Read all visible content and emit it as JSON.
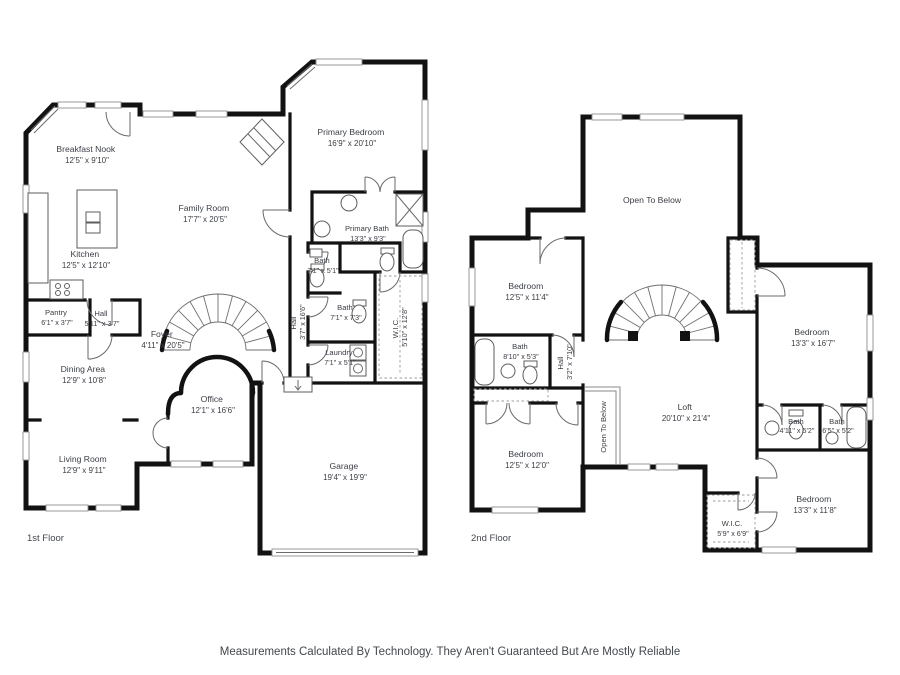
{
  "meta": {
    "disclaimer": "Measurements Calculated By Technology. They Aren't Guaranteed But Are Mostly Reliable",
    "wall_color": "#121212",
    "text_color": "#3a3e45"
  },
  "f1": {
    "floor_label": "1st Floor",
    "breakfast_nook": {
      "name": "Breakfast Nook",
      "dims": "12'5\" x 9'10\""
    },
    "kitchen": {
      "name": "Kitchen",
      "dims": "12'5\" x 12'10\""
    },
    "pantry": {
      "name": "Pantry",
      "dims": "6'1\" x 3'7\""
    },
    "hall": {
      "name": "Hall",
      "dims": "5'11\" x 3'7\""
    },
    "family_room": {
      "name": "Family Room",
      "dims": "17'7\" x 20'5\""
    },
    "foyer": {
      "name": "Foyer",
      "dims": "4'11\" x 20'5\""
    },
    "primary_bedroom": {
      "name": "Primary Bedroom",
      "dims": "16'9\" x 20'10\""
    },
    "primary_bath": {
      "name": "Primary Bath",
      "dims": "13'3\" x 9'3\""
    },
    "bath_small": {
      "name": "Bath",
      "dims": "7'1\" x 5'1\""
    },
    "bath": {
      "name": "Bath",
      "dims": "7'1\" x 7'3\""
    },
    "laundry": {
      "name": "Laundry",
      "dims": "7'1\" x 5'1\""
    },
    "hall_long": {
      "name": "Hall",
      "dims": "3'7\" x 16'6\""
    },
    "wic": {
      "name": "W.I.C.",
      "dims": "5'10\" x 12'8\""
    },
    "dining": {
      "name": "Dining Area",
      "dims": "12'9\" x 10'8\""
    },
    "office": {
      "name": "Office",
      "dims": "12'1\" x 16'6\""
    },
    "living": {
      "name": "Living Room",
      "dims": "12'9\" x 9'11\""
    },
    "garage": {
      "name": "Garage",
      "dims": "19'4\" x 19'9\""
    }
  },
  "f2": {
    "floor_label": "2nd Floor",
    "open_below": {
      "name": "Open To Below"
    },
    "bedroom_nw": {
      "name": "Bedroom",
      "dims": "12'5\" x 11'4\""
    },
    "bath_left": {
      "name": "Bath",
      "dims": "8'10\" x 5'3\""
    },
    "hall": {
      "name": "Hall",
      "dims": "3'2\" x 7'10\""
    },
    "loft": {
      "name": "Loft",
      "dims": "20'10\" x 21'4\""
    },
    "open_below_rail": {
      "name": "Open To Below"
    },
    "bedroom_sw": {
      "name": "Bedroom",
      "dims": "12'5\" x 12'0\""
    },
    "bedroom_e": {
      "name": "Bedroom",
      "dims": "13'3\" x 16'7\""
    },
    "bath_mid": {
      "name": "Bath",
      "dims": "4'11\" x 5'2\""
    },
    "bath_right": {
      "name": "Bath",
      "dims": "6'5\" x 5'2\""
    },
    "bedroom_se": {
      "name": "Bedroom",
      "dims": "13'3\" x 11'8\""
    },
    "wic": {
      "name": "W.I.C.",
      "dims": "5'9\" x 6'9\""
    }
  }
}
